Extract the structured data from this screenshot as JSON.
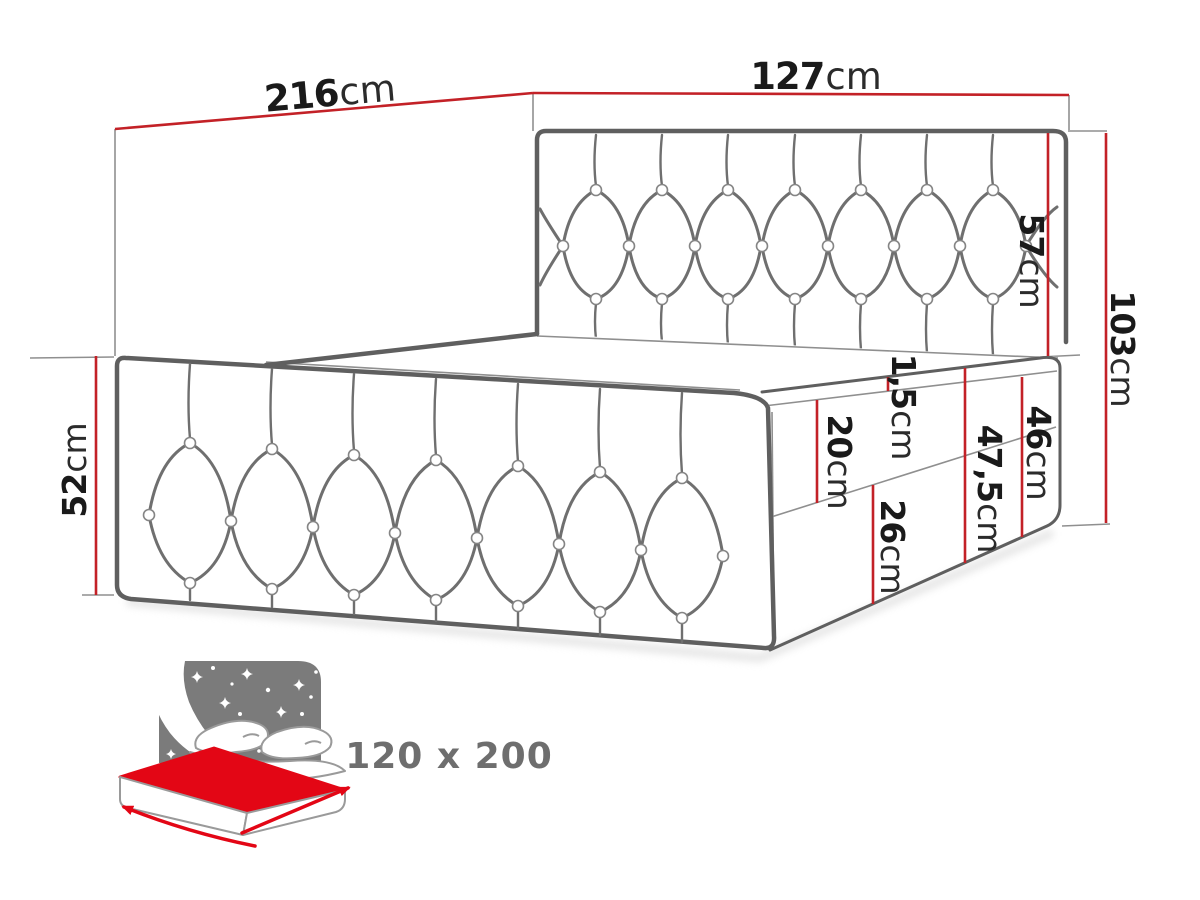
{
  "title": "Bed size diagram",
  "dimensions": {
    "length": {
      "value": "216",
      "unit": "cm"
    },
    "width": {
      "value": "127",
      "unit": "cm"
    },
    "side_height": {
      "value": "52",
      "unit": "cm"
    },
    "headboard_above_mattress": {
      "value": "57",
      "unit": "cm"
    },
    "total_height": {
      "value": "103",
      "unit": "cm"
    },
    "topper_height": {
      "value": "1,5",
      "unit": "cm"
    },
    "mattress_height": {
      "value": "20",
      "unit": "cm"
    },
    "base_and_mattress_height": {
      "value": "47,5",
      "unit": "cm"
    },
    "base_and_mattress_no_topper": {
      "value": "46",
      "unit": "cm"
    },
    "base_height": {
      "value": "26",
      "unit": "cm"
    }
  },
  "badge": {
    "size_label": "120 x 200"
  },
  "colors": {
    "dimension_red": "#c32127",
    "icon_red": "#e30615",
    "line_gray": "#5f5f5f",
    "tuft_gray": "#6f6f6f",
    "thin_gray": "#8f8f8f",
    "icon_gray": "#7b7b7b",
    "label_text": "#1a1a1a",
    "size_text": "#6e6e6e"
  }
}
